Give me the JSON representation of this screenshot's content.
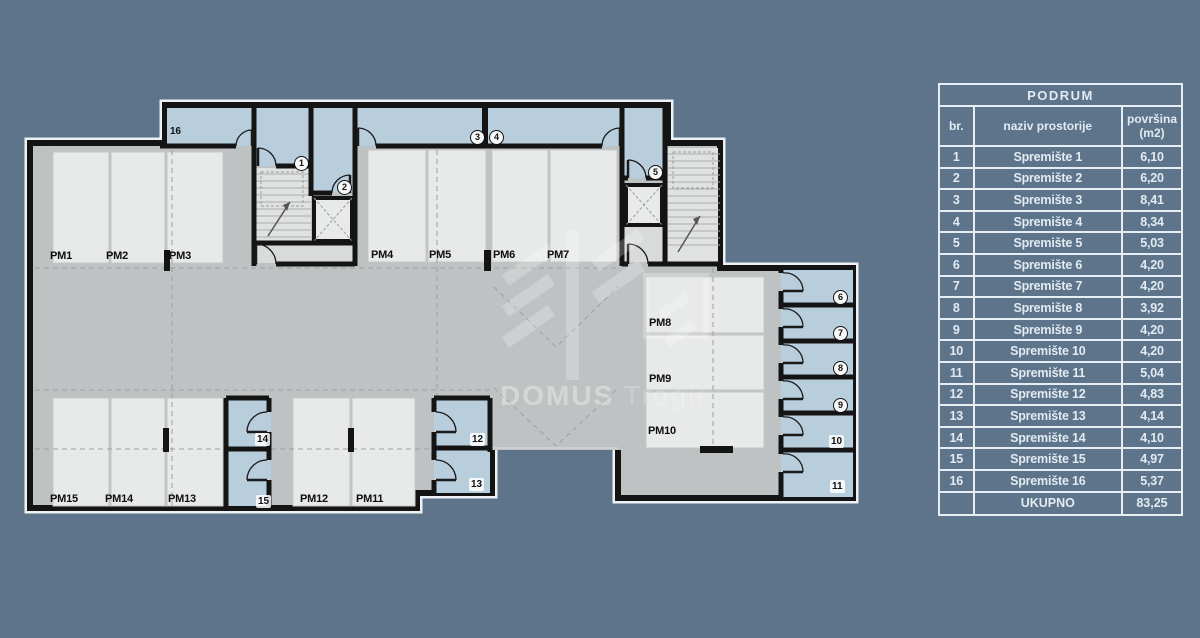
{
  "plan": {
    "watermark": {
      "brand": "DOMUS",
      "location": "Trogir"
    },
    "parking_labels": [
      "PM1",
      "PM2",
      "PM3",
      "PM4",
      "PM5",
      "PM6",
      "PM7",
      "PM8",
      "PM9",
      "PM10",
      "PM11",
      "PM12",
      "PM13",
      "PM14",
      "PM15"
    ],
    "room_numbers": [
      "1",
      "2",
      "3",
      "4",
      "5",
      "6",
      "7",
      "8",
      "9",
      "10",
      "11",
      "12",
      "13",
      "14",
      "15",
      "16"
    ]
  },
  "table": {
    "title": "PODRUM",
    "col_br": "br.",
    "col_naziv": "naziv prostorije",
    "col_povrsina": "površina",
    "col_povrsina_unit": "(m2)",
    "rows": [
      {
        "br": "1",
        "naziv": "Spremište 1",
        "m2": "6,10"
      },
      {
        "br": "2",
        "naziv": "Spremište 2",
        "m2": "6,20"
      },
      {
        "br": "3",
        "naziv": "Spremište 3",
        "m2": "8,41"
      },
      {
        "br": "4",
        "naziv": "Spremište 4",
        "m2": "8,34"
      },
      {
        "br": "5",
        "naziv": "Spremište 5",
        "m2": "5,03"
      },
      {
        "br": "6",
        "naziv": "Spremište 6",
        "m2": "4,20"
      },
      {
        "br": "7",
        "naziv": "Spremište 7",
        "m2": "4,20"
      },
      {
        "br": "8",
        "naziv": "Spremište 8",
        "m2": "3,92"
      },
      {
        "br": "9",
        "naziv": "Spremište 9",
        "m2": "4,20"
      },
      {
        "br": "10",
        "naziv": "Spremište 10",
        "m2": "4,20"
      },
      {
        "br": "11",
        "naziv": "Spremište 11",
        "m2": "5,04"
      },
      {
        "br": "12",
        "naziv": "Spremište 12",
        "m2": "4,83"
      },
      {
        "br": "13",
        "naziv": "Spremište 13",
        "m2": "4,14"
      },
      {
        "br": "14",
        "naziv": "Spremište 14",
        "m2": "4,10"
      },
      {
        "br": "15",
        "naziv": "Spremište 15",
        "m2": "4,97"
      },
      {
        "br": "16",
        "naziv": "Spremište 16",
        "m2": "5,37"
      }
    ],
    "total_label": "UKUPNO",
    "total_m2": "83,25"
  },
  "colors": {
    "background": "#5d748b",
    "floor": "#bfc2c3",
    "storage_room_fill": "#b9cedd",
    "stall_fill": "#e8e9e9",
    "wall": "#141414",
    "table_text": "#e2ebf2"
  }
}
